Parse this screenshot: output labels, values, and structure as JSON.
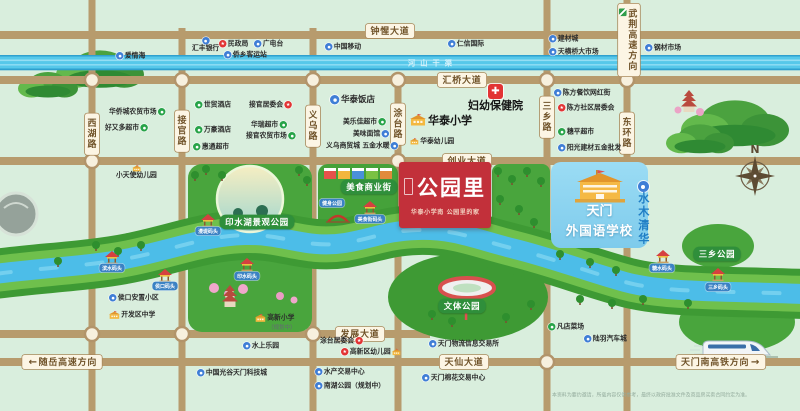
{
  "project": {
    "name": "公园里",
    "tagline": "华泰小学南 公园里的家"
  },
  "school_panel": {
    "line1": "天门",
    "line2": "外国语学校"
  },
  "residence": {
    "label": "水木清华"
  },
  "canal": {
    "name": "河山干渠"
  },
  "compass": {
    "label": "N"
  },
  "disclaimer": "本资料为要约邀请，所载内容仅供参考，最终以政府批准文件及商品房买卖合同约定为准。",
  "colors": {
    "road": "#b79b6d",
    "water": "#4cbde8",
    "park_green": "#49a53d",
    "banner_red": "#c2303a",
    "panel_blue": "#8ed5ef",
    "poi_blue": "#3f7ed6",
    "poi_green": "#27a348",
    "poi_red": "#e23434"
  },
  "road_labels": {
    "horizontal": [
      {
        "label": "钟惺大道",
        "x": 390,
        "y": 31
      },
      {
        "label": "汇桥大道",
        "x": 462,
        "y": 80
      },
      {
        "label": "创业大道",
        "x": 467,
        "y": 161
      },
      {
        "label": "发展大道",
        "x": 360,
        "y": 334
      },
      {
        "label": "天仙大道",
        "x": 464,
        "y": 362
      }
    ],
    "vertical": [
      {
        "label": "西湖路",
        "x": 92,
        "y": 134
      },
      {
        "label": "接官路",
        "x": 182,
        "y": 131
      },
      {
        "label": "义乌路",
        "x": 313,
        "y": 126
      },
      {
        "label": "涂台路",
        "x": 398,
        "y": 124
      },
      {
        "label": "三乡路",
        "x": 547,
        "y": 117
      },
      {
        "label": "东环路",
        "x": 627,
        "y": 133
      }
    ],
    "directions": [
      {
        "label": "随岳高速方向",
        "arrow": "left",
        "x": 62,
        "y": 362
      },
      {
        "label": "天门南高铁方向",
        "arrow": "right",
        "x": 721,
        "y": 362
      },
      {
        "label": "武荆高速方向",
        "vertical": 1,
        "highway": 1,
        "x": 629,
        "y": 40
      }
    ]
  },
  "park_labels": [
    {
      "label": "印水湖景观公园",
      "x": 257,
      "y": 222
    },
    {
      "label": "美食商业街",
      "x": 369,
      "y": 187
    },
    {
      "label": "文体公园",
      "x": 462,
      "y": 306
    },
    {
      "label": "三乡公园",
      "x": 717,
      "y": 254
    }
  ],
  "dock_labels": [
    {
      "label": "漫堤码头",
      "x": 208,
      "y": 231
    },
    {
      "label": "健身公园",
      "x": 332,
      "y": 203
    },
    {
      "label": "美食街码头",
      "x": 370,
      "y": 219
    },
    {
      "label": "滨水码头",
      "x": 112,
      "y": 268
    },
    {
      "label": "侯口码头",
      "x": 165,
      "y": 286
    },
    {
      "label": "印水码头",
      "x": 247,
      "y": 276
    },
    {
      "label": "糖水码头",
      "x": 662,
      "y": 268
    },
    {
      "label": "三乡码头",
      "x": 718,
      "y": 287
    }
  ],
  "pois": [
    {
      "label": "爱情海",
      "icon": "blue",
      "x": 116,
      "y": 52
    },
    {
      "label": "汇丰银行",
      "icon": "blue",
      "stack": 1,
      "x": 192,
      "y": 37
    },
    {
      "label": "民政局",
      "icon": "red",
      "x": 219,
      "y": 40
    },
    {
      "label": "广电台",
      "icon": "blue",
      "x": 254,
      "y": 40
    },
    {
      "label": "侨乡客运站",
      "icon": "blue",
      "x": 224,
      "y": 51
    },
    {
      "label": "中国移动",
      "icon": "blue",
      "x": 325,
      "y": 43
    },
    {
      "label": "仁信国际",
      "icon": "blue",
      "x": 448,
      "y": 40
    },
    {
      "label": "建材城",
      "icon": "blue",
      "x": 549,
      "y": 35
    },
    {
      "label": "天横桥大市场",
      "icon": "blue",
      "x": 549,
      "y": 48
    },
    {
      "label": "钢材市场",
      "icon": "blue",
      "x": 645,
      "y": 44
    },
    {
      "label": "华侨城农贸市场",
      "icon": "green",
      "side": "r",
      "x": 109,
      "y": 108
    },
    {
      "label": "好又多超市",
      "icon": "green",
      "side": "r",
      "x": 105,
      "y": 124
    },
    {
      "label": "世贸酒店",
      "icon": "green",
      "x": 195,
      "y": 101
    },
    {
      "label": "接官居委会",
      "icon": "red",
      "side": "r",
      "x": 249,
      "y": 101
    },
    {
      "label": "万豪酒店",
      "icon": "green",
      "x": 195,
      "y": 126
    },
    {
      "label": "华瑞超市",
      "icon": "green",
      "side": "r",
      "x": 251,
      "y": 121
    },
    {
      "label": "接官农贸市场",
      "icon": "green",
      "side": "r",
      "x": 246,
      "y": 132
    },
    {
      "label": "惠通超市",
      "icon": "green",
      "x": 193,
      "y": 143
    },
    {
      "label": "华泰饭店",
      "icon": "blue",
      "cls": "b",
      "x": 330,
      "y": 95
    },
    {
      "label": "美乐佳超市",
      "icon": "green",
      "side": "r",
      "x": 343,
      "y": 118
    },
    {
      "label": "美味面馆",
      "icon": "blue",
      "side": "r",
      "x": 353,
      "y": 130
    },
    {
      "label": "义乌商贸城 五金水暖",
      "icon": "blue",
      "side": "r",
      "x": 326,
      "y": 142
    },
    {
      "label": "华泰小学",
      "icon": "school",
      "cls": "xl",
      "x": 410,
      "y": 114
    },
    {
      "label": "华泰幼儿园",
      "icon": "school2",
      "x": 410,
      "y": 138
    },
    {
      "label": "妇幼保健院",
      "icon": "cross",
      "cls": "xl",
      "stack": 1,
      "x": 468,
      "y": 84
    },
    {
      "label": "陈方餐饮网红街",
      "icon": "blue",
      "x": 554,
      "y": 89
    },
    {
      "label": "陈方社区居委会",
      "icon": "red",
      "x": 558,
      "y": 104
    },
    {
      "label": "穗平超市",
      "icon": "green",
      "x": 558,
      "y": 128
    },
    {
      "label": "阳光建材五金批发",
      "icon": "blue",
      "x": 558,
      "y": 144
    },
    {
      "label": "小天使幼儿园",
      "icon": "school2",
      "stack": 1,
      "x": 116,
      "y": 165
    },
    {
      "label": "侯口安置小区",
      "icon": "blue",
      "x": 109,
      "y": 294
    },
    {
      "label": "开发区中学",
      "icon": "school",
      "x": 109,
      "y": 311
    },
    {
      "label": "高新小学",
      "icon": "school",
      "x": 255,
      "y": 314
    },
    {
      "label": "（规划中）",
      "icon": "none",
      "cls": "sub",
      "x": 268,
      "y": 325
    },
    {
      "label": "水上乐园",
      "icon": "blue",
      "x": 243,
      "y": 342
    },
    {
      "label": "涂台居委会",
      "icon": "red",
      "side": "r",
      "x": 320,
      "y": 337
    },
    {
      "label": "高新区幼儿园",
      "icon": "red",
      "icon2": "school2",
      "x": 341,
      "y": 348
    },
    {
      "label": "天门物流信息交易所",
      "icon": "blue",
      "x": 429,
      "y": 340
    },
    {
      "label": "水产交易中心",
      "icon": "blue",
      "x": 315,
      "y": 368
    },
    {
      "label": "南湖公园（规划中）",
      "icon": "blue",
      "x": 315,
      "y": 382
    },
    {
      "label": "天门棉花交易中心",
      "icon": "blue",
      "x": 422,
      "y": 374
    },
    {
      "label": "中国光谷天门科技城",
      "icon": "blue",
      "x": 197,
      "y": 369
    },
    {
      "label": "凡店菜场",
      "icon": "green",
      "x": 548,
      "y": 323
    },
    {
      "label": "陆羽汽车城",
      "icon": "blue",
      "x": 584,
      "y": 335
    }
  ]
}
